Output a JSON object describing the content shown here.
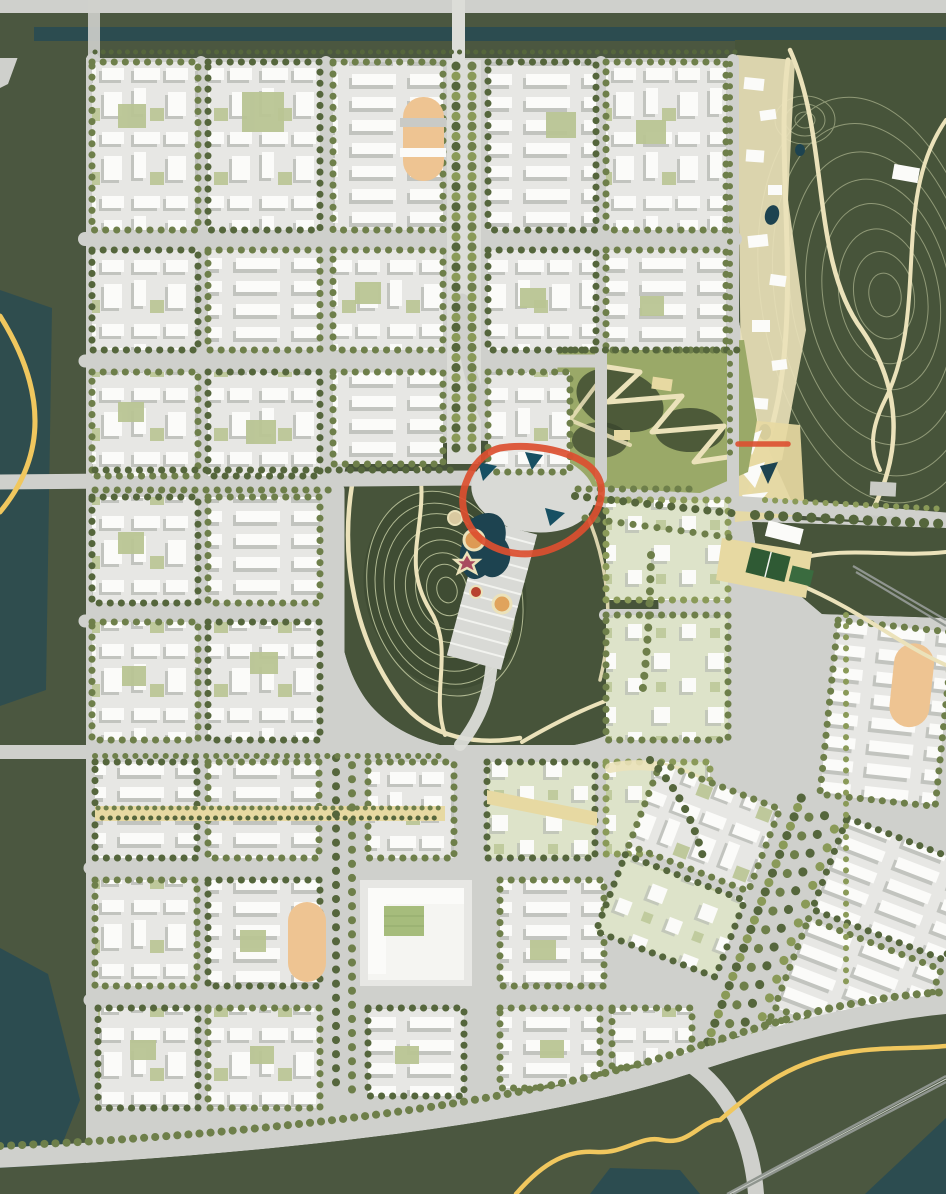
{
  "meta": {
    "type": "urban-masterplan-aerial-rendering",
    "width": 946,
    "height": 1194
  },
  "palette": {
    "road": "#cfd0cc",
    "road_light": "#dcddd8",
    "block": "#e7e7e4",
    "pale": "#dde3c9",
    "white": "#fbfbf9",
    "shadow": "#b3b5b0",
    "tree_dark": "#55663c",
    "tree_mid": "#6e7f4a",
    "tree_light": "#8a9a58",
    "forest": "#4b5740",
    "forest_dark": "#39462d",
    "park": "#47543a",
    "contour": "#ccd3a9",
    "cream": "#ebe2ba",
    "tan": "#e7d9a2",
    "water": "#2c4c50",
    "water_dark": "#1d4350",
    "yellow": "#f0c75e",
    "red": "#dc4f30",
    "track": "#eec492",
    "court": "#2f5a34",
    "pitch": "#a6bc7c",
    "courtyard": "#b9c594",
    "rail": "#8f958f",
    "plaza": "#d9dad6",
    "plaza_stripe": "#f2f3ef",
    "canopy": "#175063"
  },
  "features": {
    "annotations": {
      "focus_ring": {
        "shape": "rounded-triangle-outline",
        "color_ref": "red"
      },
      "link_marker_east": {
        "shape": "short-line",
        "color_ref": "red"
      },
      "greenway_west": {
        "shape": "arc",
        "color_ref": "yellow"
      },
      "greenway_southeast": {
        "shape": "s-curve",
        "color_ref": "yellow"
      }
    },
    "parks": {
      "northeast_hill_park": {
        "style": "dark-green-with-contour-lines-and-cream-paths"
      },
      "central_hill_park": {
        "style": "dark-green-with-contour-lines-playground-dots"
      },
      "east_zigzag_garden": {
        "style": "light-green-with-zigzag-paths"
      }
    },
    "water_bodies": {
      "count": 6,
      "color_ref": "water"
    },
    "sports_fields": {
      "count": 3,
      "color_ref": "track"
    },
    "sports_courts": {
      "count": 2,
      "color_ref": "court"
    },
    "rail_lines": {
      "count": 2,
      "color_ref": "rail"
    },
    "city_blocks": {
      "style": "white-buildings-with-street-tree-rows",
      "color_ref": "block"
    }
  }
}
